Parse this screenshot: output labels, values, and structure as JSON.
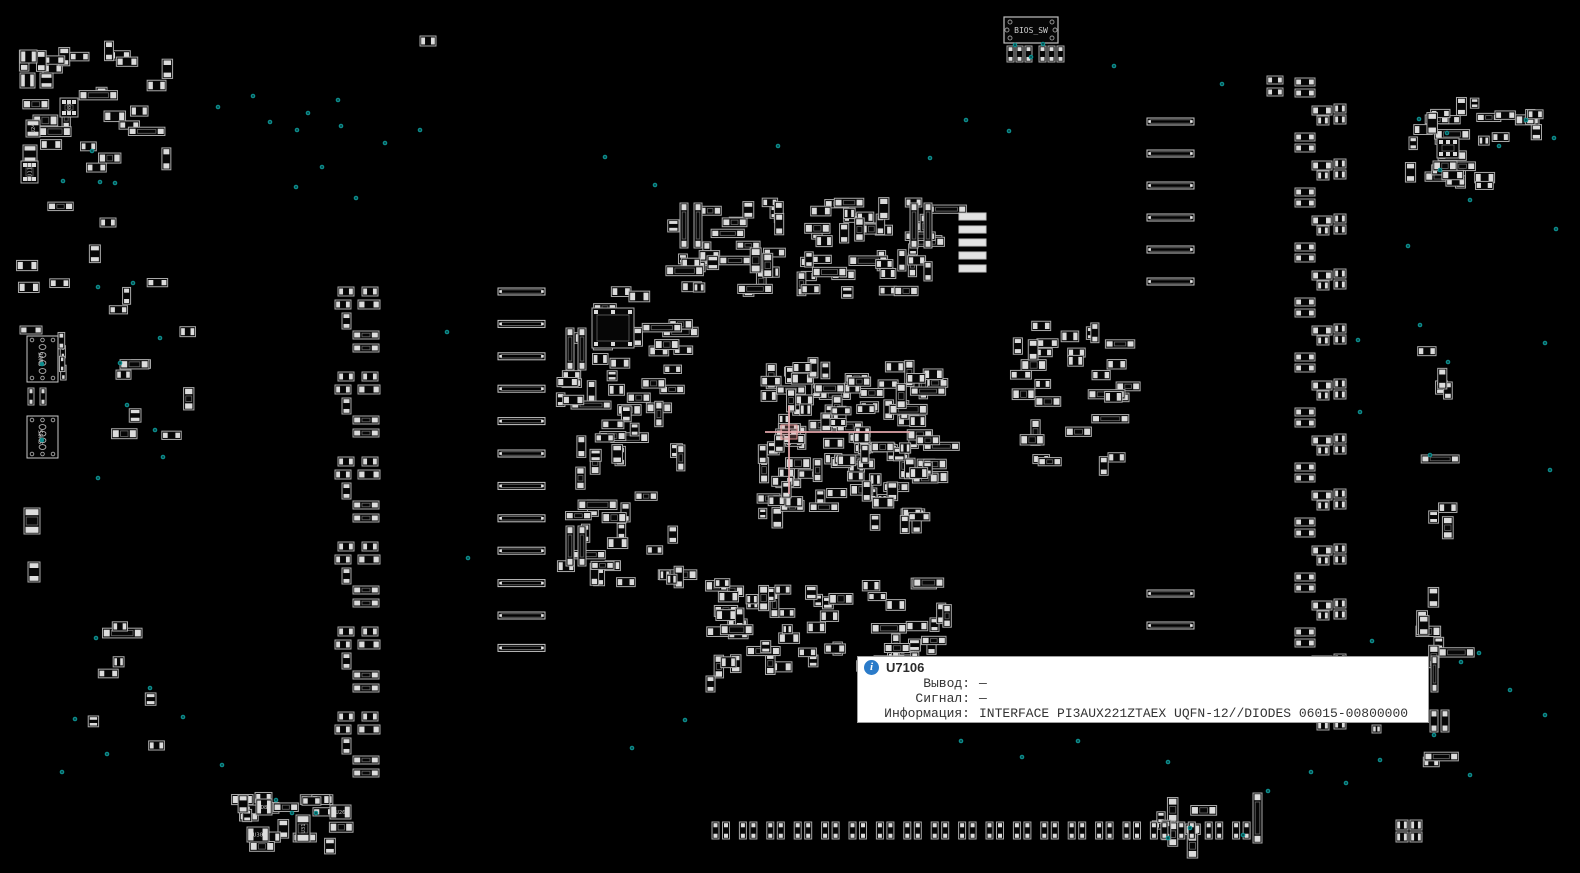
{
  "app": {
    "tooltip": {
      "ref": "U7106",
      "rows": [
        {
          "label": "Вывод:",
          "value": "—"
        },
        {
          "label": "Сигнал:",
          "value": "—"
        },
        {
          "label": "Информация:",
          "value": "INTERFACE PI3AUX221ZTAEX UQFN-12//DIODES 06015-00800000"
        }
      ]
    }
  },
  "colors": {
    "board_bg": "#000000",
    "component_stroke": "#a9a9a9",
    "pad_fill": "#dcdcdc",
    "bar_stroke": "#c6c6c6",
    "bar_filled": "#e2e2e2",
    "dot": "#0d8c8c",
    "crosshair": "#e7a9ad",
    "silk_text": "#c8c8c8",
    "info_icon": "#2b7bc9"
  },
  "board": {
    "bios_switch": {
      "x": 1004,
      "y": 17,
      "w": 54,
      "h": 26,
      "label": "BIOS_SW",
      "pad_y": 46,
      "pad_xs": [
        1007,
        1016,
        1025,
        1039,
        1048,
        1057
      ]
    },
    "connectors": [
      {
        "x": 27,
        "y": 336,
        "w": 31,
        "h": 46,
        "label": "SW06",
        "dot": [
          42,
          364
        ]
      },
      {
        "x": 27,
        "y": 416,
        "w": 31,
        "h": 42,
        "label": "SW05",
        "dot": [
          42,
          440
        ]
      }
    ],
    "labeled_parts": [
      {
        "x": 60,
        "y": 98,
        "w": 18,
        "h": 19,
        "label": "D88"
      },
      {
        "x": 26,
        "y": 120,
        "w": 14,
        "h": 17,
        "label": "U24"
      },
      {
        "x": 21,
        "y": 161,
        "w": 17,
        "h": 22,
        "label": "U11"
      },
      {
        "x": 256,
        "y": 799,
        "w": 16,
        "h": 16,
        "label": "D8"
      },
      {
        "x": 247,
        "y": 827,
        "w": 22,
        "h": 15,
        "label": "U30"
      },
      {
        "x": 296,
        "y": 815,
        "w": 14,
        "h": 27,
        "label": "U31"
      },
      {
        "x": 330,
        "y": 805,
        "w": 21,
        "h": 14,
        "label": "U26"
      }
    ],
    "clusters": [
      {
        "name": "top-left",
        "x": 15,
        "y": 40,
        "w": 200,
        "h": 150,
        "count": 26,
        "seed": 11
      },
      {
        "name": "top-left-lower",
        "x": 15,
        "y": 195,
        "w": 140,
        "h": 110,
        "count": 5,
        "seed": 12
      },
      {
        "name": "left-conn-side",
        "x": 58,
        "y": 328,
        "w": 26,
        "h": 65,
        "count": 4,
        "seed": 13,
        "tiny": true
      },
      {
        "name": "left-mid",
        "x": 85,
        "y": 275,
        "w": 130,
        "h": 215,
        "count": 11,
        "seed": 14
      },
      {
        "name": "left-lower",
        "x": 70,
        "y": 615,
        "w": 145,
        "h": 150,
        "count": 7,
        "seed": 15
      },
      {
        "name": "center-left",
        "x": 555,
        "y": 285,
        "w": 150,
        "h": 310,
        "count": 66,
        "seed": 16
      },
      {
        "name": "top-center",
        "x": 665,
        "y": 195,
        "w": 290,
        "h": 115,
        "count": 72,
        "seed": 17
      },
      {
        "name": "center-dense",
        "x": 757,
        "y": 357,
        "w": 196,
        "h": 176,
        "count": 118,
        "seed": 18
      },
      {
        "name": "center-bottom",
        "x": 700,
        "y": 578,
        "w": 270,
        "h": 100,
        "count": 58,
        "seed": 19
      },
      {
        "name": "right-center",
        "x": 1010,
        "y": 315,
        "w": 135,
        "h": 160,
        "count": 30,
        "seed": 20
      },
      {
        "name": "far-right-top",
        "x": 1398,
        "y": 95,
        "w": 112,
        "h": 105,
        "count": 24,
        "seed": 21
      },
      {
        "name": "right-edge-top",
        "x": 1490,
        "y": 105,
        "w": 72,
        "h": 60,
        "count": 7,
        "seed": 22
      },
      {
        "name": "far-right-mid",
        "x": 1415,
        "y": 330,
        "w": 55,
        "h": 260,
        "count": 8,
        "seed": 23
      },
      {
        "name": "far-right-low",
        "x": 1412,
        "y": 575,
        "w": 60,
        "h": 205,
        "count": 9,
        "seed": 24
      },
      {
        "name": "bottom-left",
        "x": 228,
        "y": 790,
        "w": 135,
        "h": 68,
        "count": 18,
        "seed": 25
      },
      {
        "name": "bottom-right-misc",
        "x": 1150,
        "y": 795,
        "w": 95,
        "h": 55,
        "count": 8,
        "seed": 26
      }
    ],
    "bar_columns": [
      {
        "x": 498,
        "y0": 288,
        "count": 12,
        "step": 32.4,
        "w": 47,
        "h": 7,
        "filled": false
      },
      {
        "x": 1147,
        "y0": 118,
        "count": 6,
        "step": 32,
        "w": 47,
        "h": 7,
        "filled": false
      },
      {
        "x": 1147,
        "y0": 590,
        "count": 2,
        "step": 32,
        "w": 47,
        "h": 7,
        "filled": false
      },
      {
        "x": 959,
        "y0": 213,
        "count": 5,
        "step": 13,
        "w": 27,
        "h": 7,
        "filled": true
      }
    ],
    "repeat_groups": [
      {
        "x": 320,
        "y0": 287,
        "step": 85,
        "count": 6,
        "parts": [
          [
            18,
            0,
            16,
            9
          ],
          [
            42,
            0,
            16,
            9
          ],
          [
            15,
            13,
            16,
            9
          ],
          [
            38,
            13,
            22,
            9
          ],
          [
            22,
            26,
            9,
            16
          ],
          [
            33,
            44,
            26,
            8
          ],
          [
            33,
            57,
            26,
            8
          ]
        ]
      },
      {
        "x": 1295,
        "y0": 78,
        "step": 55,
        "count": 12,
        "parts": [
          [
            0,
            0,
            20,
            8
          ],
          [
            0,
            11,
            20,
            8
          ],
          [
            17,
            28,
            20,
            9
          ],
          [
            39,
            26,
            12,
            9
          ],
          [
            39,
            37,
            12,
            9
          ],
          [
            22,
            38,
            12,
            9
          ]
        ]
      }
    ],
    "pad_row": {
      "x0": 712,
      "y": 822,
      "pairs": 20,
      "step": 27.4,
      "pw": 7,
      "ph": 17,
      "gap": 3.5
    },
    "parts": [
      [
        20,
        326,
        22,
        8
      ],
      [
        28,
        388,
        6,
        17
      ],
      [
        40,
        388,
        6,
        17
      ],
      [
        24,
        508,
        16,
        26
      ],
      [
        28,
        562,
        12,
        20
      ],
      [
        20,
        50,
        17,
        13
      ],
      [
        20,
        73,
        15,
        15
      ],
      [
        40,
        73,
        13,
        15
      ],
      [
        23,
        145,
        14,
        18
      ],
      [
        680,
        203,
        8,
        45
      ],
      [
        694,
        203,
        8,
        45
      ],
      [
        910,
        203,
        8,
        45
      ],
      [
        924,
        203,
        8,
        45
      ],
      [
        566,
        328,
        8,
        42
      ],
      [
        578,
        328,
        8,
        42
      ],
      [
        566,
        526,
        8,
        40
      ],
      [
        578,
        526,
        8,
        40
      ],
      [
        420,
        36,
        16,
        10
      ],
      [
        100,
        218,
        16,
        9
      ],
      [
        706,
        676,
        9,
        16
      ],
      [
        1267,
        76,
        16,
        8
      ],
      [
        1267,
        88,
        16,
        8
      ],
      [
        592,
        308,
        42,
        40
      ],
      [
        1437,
        138,
        22,
        20
      ],
      [
        1253,
        793,
        9,
        50
      ],
      [
        1431,
        656,
        7,
        36
      ],
      [
        1430,
        710,
        8,
        22
      ],
      [
        1441,
        710,
        8,
        22
      ],
      [
        1372,
        725,
        9,
        8
      ],
      [
        1396,
        820,
        12,
        10
      ],
      [
        1410,
        820,
        12,
        10
      ],
      [
        1396,
        832,
        12,
        10
      ],
      [
        1410,
        832,
        12,
        10
      ]
    ],
    "crosshair": {
      "hx1": 765,
      "hx2": 910,
      "hy": 432,
      "vx": 789,
      "vy1": 406,
      "vy2": 494,
      "box": [
        781,
        425,
        16,
        14
      ]
    },
    "dots": [
      [
        218,
        107
      ],
      [
        253,
        96
      ],
      [
        270,
        122
      ],
      [
        297,
        130
      ],
      [
        341,
        126
      ],
      [
        322,
        167
      ],
      [
        296,
        187
      ],
      [
        356,
        198
      ],
      [
        308,
        113
      ],
      [
        338,
        100
      ],
      [
        385,
        143
      ],
      [
        420,
        130
      ],
      [
        92,
        151
      ],
      [
        63,
        181
      ],
      [
        100,
        182
      ],
      [
        115,
        183
      ],
      [
        605,
        157
      ],
      [
        655,
        185
      ],
      [
        778,
        146
      ],
      [
        930,
        158
      ],
      [
        966,
        120
      ],
      [
        1009,
        131
      ],
      [
        1114,
        66
      ],
      [
        1222,
        84
      ],
      [
        1015,
        45
      ],
      [
        1043,
        44
      ],
      [
        1031,
        57
      ],
      [
        1419,
        119
      ],
      [
        1447,
        133
      ],
      [
        1499,
        146
      ],
      [
        1526,
        120
      ],
      [
        1554,
        138
      ],
      [
        1440,
        170
      ],
      [
        1470,
        200
      ],
      [
        1556,
        229
      ],
      [
        1408,
        246
      ],
      [
        98,
        287
      ],
      [
        133,
        283
      ],
      [
        160,
        338
      ],
      [
        120,
        363
      ],
      [
        127,
        405
      ],
      [
        155,
        430
      ],
      [
        163,
        457
      ],
      [
        98,
        478
      ],
      [
        447,
        332
      ],
      [
        468,
        558
      ],
      [
        62,
        772
      ],
      [
        75,
        719
      ],
      [
        107,
        754
      ],
      [
        150,
        688
      ],
      [
        183,
        717
      ],
      [
        96,
        638
      ],
      [
        276,
        800
      ],
      [
        292,
        813
      ],
      [
        316,
        813
      ],
      [
        222,
        765
      ],
      [
        632,
        748
      ],
      [
        685,
        720
      ],
      [
        1358,
        340
      ],
      [
        1420,
        325
      ],
      [
        1448,
        362
      ],
      [
        1545,
        343
      ],
      [
        1360,
        412
      ],
      [
        1430,
        455
      ],
      [
        1550,
        470
      ],
      [
        1372,
        641
      ],
      [
        1479,
        653
      ],
      [
        1461,
        662
      ],
      [
        1434,
        735
      ],
      [
        1398,
        667
      ],
      [
        1510,
        690
      ],
      [
        1545,
        715
      ],
      [
        1380,
        760
      ],
      [
        1470,
        775
      ],
      [
        961,
        741
      ],
      [
        1022,
        757
      ],
      [
        1078,
        741
      ],
      [
        1168,
        762
      ],
      [
        1311,
        772
      ],
      [
        1346,
        783
      ],
      [
        1268,
        791
      ],
      [
        1168,
        838
      ],
      [
        1190,
        828
      ],
      [
        1243,
        835
      ]
    ]
  }
}
